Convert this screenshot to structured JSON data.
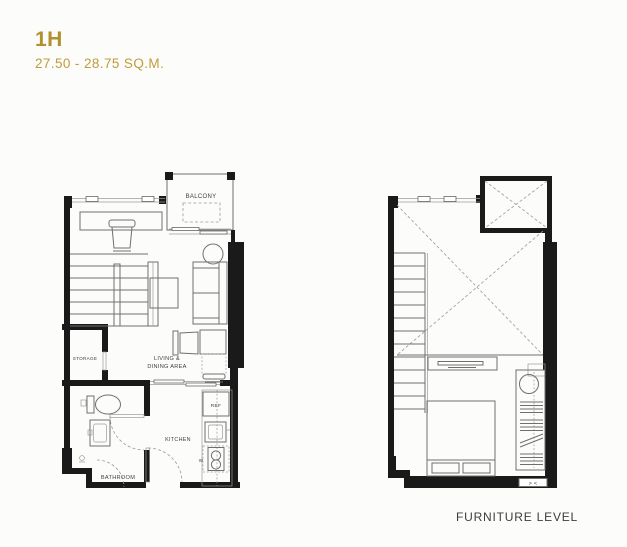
{
  "header": {
    "unit": "1H",
    "area": "27.50 - 28.75 SQ.M."
  },
  "plans": {
    "main": {
      "labels": {
        "balcony": "BALCONY",
        "storage": "STORAGE",
        "living1": "LIVING &",
        "living2": "DINING AREA",
        "bathroom": "BATHROOM",
        "kitchen": "KITCHEN",
        "ref": "REF",
        "washer": "W"
      }
    },
    "furniture": {
      "caption": "FURNITURE LEVEL",
      "louver_glyph": "> <"
    }
  },
  "colors": {
    "accent_gold": "#B2902E",
    "area_gold": "#C09B3D",
    "wall_black": "#1A1A1A",
    "furniture_stroke": "#6F6F6F",
    "label_gray": "#3F3F3F"
  }
}
